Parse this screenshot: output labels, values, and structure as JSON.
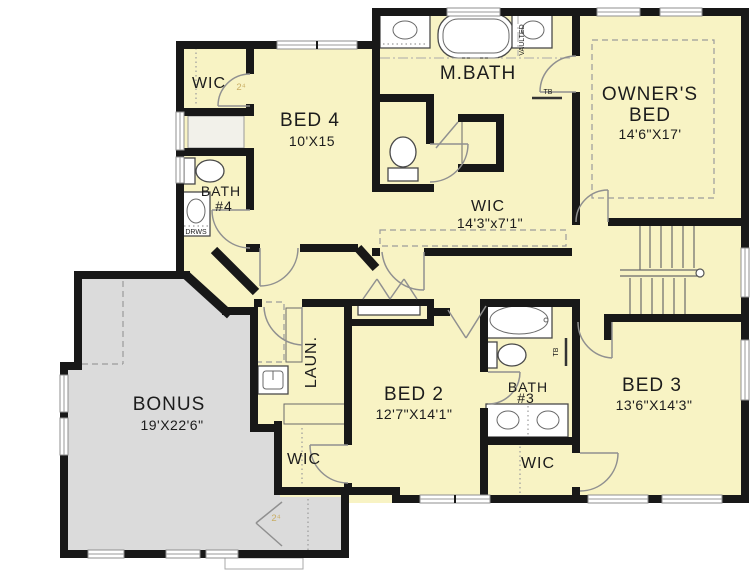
{
  "plan": {
    "colors": {
      "room_fill": "#F8F3C4",
      "bonus_fill": "#DBDBDB",
      "wall": "#181818",
      "window": "#8f8f8f",
      "door_arc": "#909090",
      "text": "#1c1c1c",
      "door_tag": "#C9AE64"
    },
    "rooms": {
      "wic4": {
        "label": "WIC"
      },
      "bed4": {
        "label": "BED 4",
        "dims": "10'X15"
      },
      "bath4": {
        "line1": "BATH",
        "line2": "#4"
      },
      "mbath": {
        "label": "M.BATH"
      },
      "owner_wic": {
        "label": "WIC",
        "dims": "14'3\"x7'1\""
      },
      "owner_bed": {
        "line1": "OWNER'S",
        "line2": "BED",
        "dims": "14'6\"X17'"
      },
      "bonus": {
        "label": "BONUS",
        "dims": "19'X22'6\""
      },
      "laundry": {
        "label": "LAUN."
      },
      "bed2": {
        "label": "BED 2",
        "dims": "12'7\"X14'1\""
      },
      "bath3": {
        "line1": "BATH",
        "line2": "#3"
      },
      "bed3": {
        "label": "BED 3",
        "dims": "13'6\"X14'3\""
      },
      "wic2": {
        "label": "WIC"
      },
      "wic3": {
        "label": "WIC"
      }
    },
    "annotations": {
      "vaulted": "VAULTED",
      "drawers": "DRWS",
      "towel_bar_mbath": "TB",
      "towel_bar_bath3": "TB",
      "door_tag_wic4": "2⁴",
      "door_tag_bonus": "2⁴"
    }
  }
}
